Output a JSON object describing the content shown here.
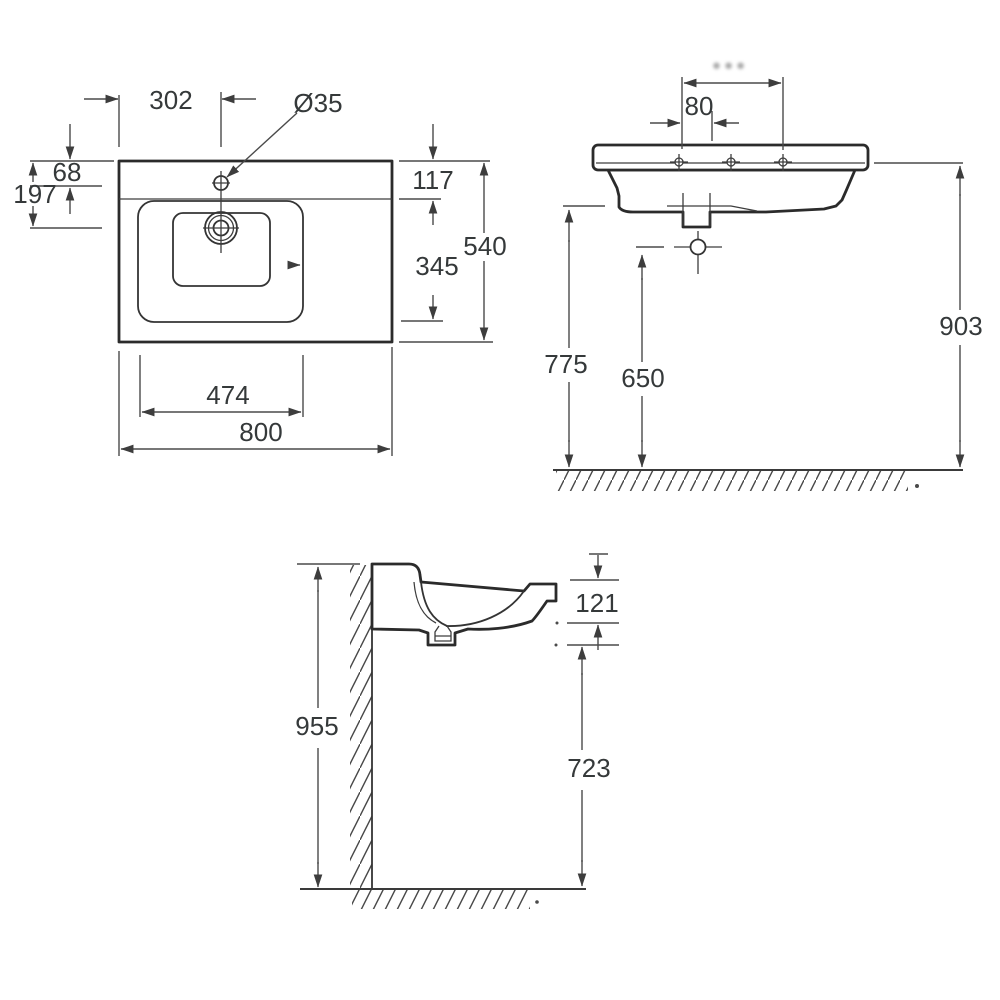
{
  "drawing": {
    "description": "washbasin dimensional drawing, three views",
    "colors": {
      "background": "#ffffff",
      "line_bold": "#2b2b2b",
      "line_thin": "#4a4a4a",
      "text": "#35393a",
      "smudge": "#a8a8a8"
    },
    "plan": {
      "dims": {
        "d302": "302",
        "dia35": "Ø35",
        "d68": "68",
        "d197": "197",
        "d117": "117",
        "d345": "345",
        "d540": "540",
        "d474": "474",
        "d800": "800"
      }
    },
    "front": {
      "dims": {
        "smudge": "●●●",
        "d80": "80",
        "d775": "775",
        "d650": "650",
        "d903": "903"
      }
    },
    "side": {
      "dims": {
        "d121": "121",
        "d955": "955",
        "d723": "723"
      }
    }
  }
}
